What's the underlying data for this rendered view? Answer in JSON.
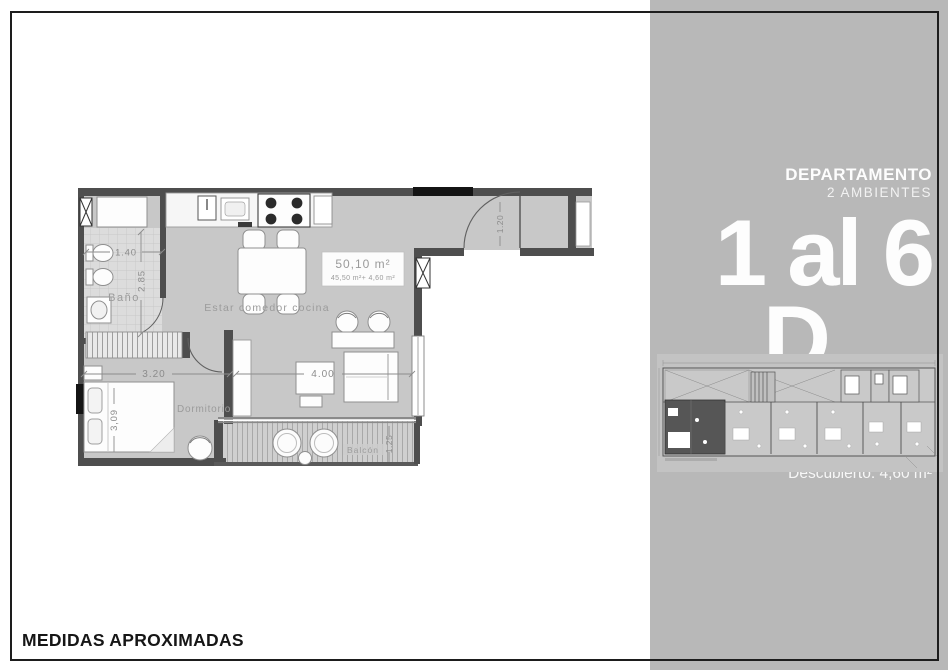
{
  "page": {
    "footer_note": "MEDIDAS APROXIMADAS"
  },
  "sidebar": {
    "panel_color": "#b8b8b8",
    "text_color": "#ffffff",
    "title": "DEPARTAMENTO",
    "subtitle": "2 AMBIENTES",
    "unit_range": "1 al 6",
    "unit_letter": "D",
    "total_area": "50,10 M²",
    "covered_area": "Cubierta: 45,50 m²",
    "uncovered_area": "Descubierto: 4,60 m²"
  },
  "floor_plan": {
    "area_box": {
      "line1": "50,10 m²",
      "line2": "45,50 m²+ 4,60 m²"
    },
    "rooms": {
      "bathroom": "Baño",
      "living_dining_kitchen": "Estar comedor cocina",
      "bedroom": "Dormitorio",
      "balcony": "Balcón"
    },
    "dimensions": {
      "bath_width": "1.40",
      "bath_length": "2.85",
      "bedroom_width": "3.20",
      "bedroom_length": "3,09",
      "living_width": "4.00",
      "balcony_depth": "1.25",
      "entry_width": "1.20"
    }
  }
}
